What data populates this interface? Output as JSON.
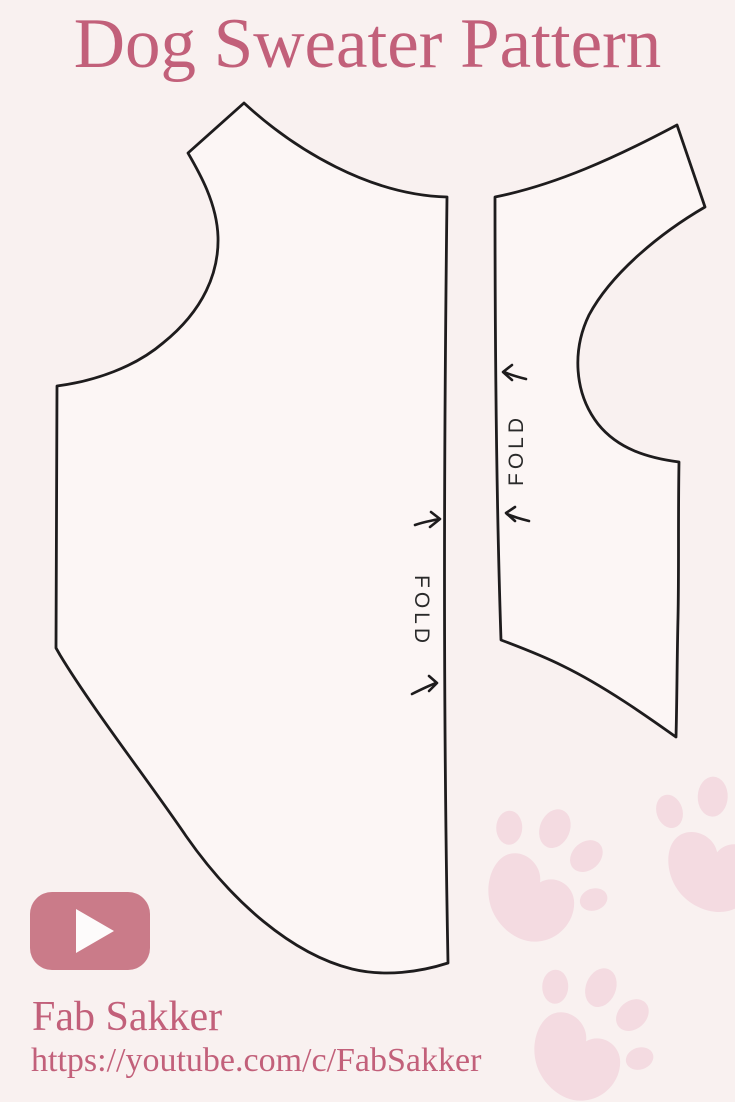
{
  "header": {
    "title": "Dog Sweater Pattern"
  },
  "diagram": {
    "back_piece_fold_label": "FOLD",
    "chest_piece_fold_label": "FOLD"
  },
  "footer": {
    "channel_name": "Fab Sakker",
    "channel_url": "https://youtube.com/c/FabSakker"
  },
  "icons": {
    "play_button": "youtube-play-icon",
    "fold_arrows": "fold-arrow-icon",
    "paw_prints": "paw-print-icon"
  },
  "colors": {
    "background": "#f9f1f0",
    "accent_text": "#c2607a",
    "play_button": "#ca7b89",
    "paw_print": "#f4dbe1",
    "outline": "#1e1c1d"
  }
}
